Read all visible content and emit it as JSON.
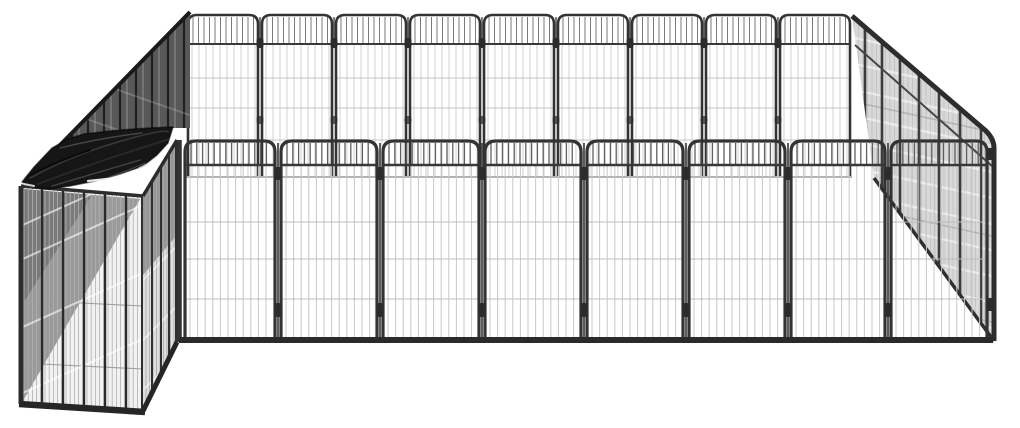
{
  "image": {
    "width": 1020,
    "height": 428,
    "background": "#ffffff",
    "subject": "black powder-coated steel dog playpen with tarp-covered kennel corner, product photo on white, no visible text"
  },
  "palette": {
    "frame": "#333333",
    "frame_dark": "#262626",
    "wire_light": "#c8c8c8",
    "mesh_shade": "#d8d8d8",
    "wedge_shade": "#555555",
    "tarp": "#161616"
  },
  "back_wall": {
    "x0": 186,
    "x1": 852,
    "panels": 9,
    "top": 15,
    "arch_r": 9,
    "crossbar": 44,
    "bottom": 176,
    "frame": "#333333",
    "frame_w": 2.6,
    "band_bar_gap": 5.5,
    "band_bar_color": "#7a7a7a",
    "wire_gap": 7,
    "wire_color": "#cccccc",
    "hwires": [
      78,
      108,
      140
    ],
    "hwire_color": "#c4c4c4",
    "bottom_line_color": "#999999",
    "knob_color": "#2c2c2c",
    "knob_y1": 38,
    "knob_y2": 116
  },
  "right_wall": {
    "poly": [
      [
        852,
        16
      ],
      [
        994,
        139
      ],
      [
        994,
        341
      ],
      [
        874,
        178
      ]
    ],
    "fill": "#d8d8d8",
    "wire_gap": 4.5,
    "wire_color": "#bfbfbf",
    "posts": [
      865,
      882,
      900,
      919,
      939,
      960,
      981
    ],
    "post_color": "#3c3c3c",
    "post_w": 2.6,
    "top_rail_d": "M852,16 L986,131 Q994,139 994,148 L994,341",
    "inner_rail": [
      [
        855,
        45
      ],
      [
        992,
        166
      ]
    ],
    "bottom_rail": [
      [
        874,
        178
      ],
      [
        994,
        341
      ]
    ],
    "rail_color": "#2d2d2d",
    "streaks": [
      {
        "slope": 0.22,
        "x0": 846,
        "x1": 1002,
        "ys": [
          36,
          62,
          88,
          114,
          140,
          166,
          192,
          218,
          244,
          270,
          296,
          322
        ],
        "color": "#ffffff",
        "opacity": 0.5,
        "width": 2.4
      },
      {
        "slope": 0.22,
        "x0": 846,
        "x1": 1002,
        "ys": [
          100,
          204,
          290
        ],
        "color": "#8f8f8f",
        "opacity": 0.45,
        "width": 1.6
      }
    ]
  },
  "left_wedge": {
    "poly": [
      [
        190,
        12
      ],
      [
        26,
        180
      ],
      [
        79,
        136
      ],
      [
        172,
        128
      ],
      [
        190,
        128
      ]
    ],
    "fill": "#585858",
    "shade_poly": [
      [
        26,
        180
      ],
      [
        79,
        136
      ],
      [
        118,
        133
      ],
      [
        70,
        178
      ]
    ],
    "shade_color": "#262626",
    "shade_opacity": 0.7,
    "posts_x": [
      40,
      56,
      72,
      88,
      104,
      120,
      136,
      152,
      168,
      184
    ],
    "post_color": "#1f1f1f",
    "post_w": 2.2,
    "wire_color": "#8f8f8f",
    "top_edge": [
      [
        190,
        12
      ],
      [
        26,
        180
      ]
    ],
    "edge_color": "#1a1a1a",
    "edge_w": 4,
    "streaks": [
      {
        "slope": 0.35,
        "x0": 18,
        "x1": 196,
        "ys": [
          55,
          95,
          135
        ],
        "color": "#ffffff",
        "opacity": 0.18,
        "width": 2
      }
    ]
  },
  "kennel_front": {
    "quad": [
      [
        21,
        186
      ],
      [
        143,
        196
      ],
      [
        143,
        411
      ],
      [
        21,
        404
      ]
    ],
    "fill": "#f2f2f2",
    "dark_tri": [
      [
        24,
        189
      ],
      [
        140,
        199
      ],
      [
        24,
        399
      ]
    ],
    "dark_fill": "#9a9a9a",
    "darker_tri": [
      [
        24,
        189
      ],
      [
        92,
        195
      ],
      [
        24,
        302
      ]
    ],
    "darker_fill": "#6f6f6f",
    "darker_opacity": 0.75,
    "wire_gap": 4.2,
    "wire_color": "#b0b0b0",
    "hwires": [
      300,
      363
    ],
    "hwire_color": "#9f9f9f",
    "posts_x": [
      42,
      63,
      84,
      105,
      126
    ],
    "post_color": "#2a2a2a",
    "post_w": 2.4,
    "streaks": [
      {
        "slope": -0.45,
        "x0": 16,
        "x1": 150,
        "ys": [
          228,
          262,
          330,
          396
        ],
        "color": "#ffffff",
        "opacity": 0.6,
        "width": 2
      }
    ],
    "frame": {
      "top": {
        "pts": [
          [
            21,
            186
          ],
          [
            143,
            196
          ]
        ],
        "c": "#2f2f2f",
        "w": 3.5
      },
      "left": {
        "pts": [
          [
            21,
            186
          ],
          [
            21,
            404
          ]
        ],
        "c": "#2c2c2c",
        "w": 5
      },
      "bottom": {
        "pts": [
          [
            19,
            404
          ],
          [
            145,
            412
          ]
        ],
        "c": "#262626",
        "w": 6.5
      },
      "right": {
        "pts": [
          [
            143,
            196
          ],
          [
            143,
            411
          ]
        ],
        "c": "#2f2f2f",
        "w": 4
      }
    }
  },
  "kennel_side": {
    "quad": [
      [
        143,
        196
      ],
      [
        177,
        140
      ],
      [
        177,
        342
      ],
      [
        143,
        411
      ]
    ],
    "fill": "#dedede",
    "dark_tri": [
      [
        143,
        196
      ],
      [
        177,
        140
      ],
      [
        177,
        235
      ],
      [
        143,
        275
      ]
    ],
    "dark_fill": "#8a8a8a",
    "dark_opacity": 0.85,
    "wire_gap": 3.5,
    "wire_color": "#a8a8a8",
    "posts_x": [
      152,
      161,
      169
    ],
    "post_color": "#303030",
    "post_w": 2,
    "streaks": [
      {
        "slope": -1.0,
        "x0": 138,
        "x1": 182,
        "ys": [
          285,
          345,
          395
        ],
        "color": "#ffffff",
        "opacity": 0.5,
        "width": 1.8
      }
    ],
    "frame": {
      "top": {
        "pts": [
          [
            143,
            196
          ],
          [
            177,
            140
          ]
        ],
        "c": "#2b2b2b",
        "w": 3.5
      },
      "bottom": {
        "pts": [
          [
            143,
            411
          ],
          [
            177,
            342
          ]
        ],
        "c": "#262626",
        "w": 5
      },
      "right": {
        "pts": [
          [
            177,
            140
          ],
          [
            177,
            342
          ]
        ],
        "c": "#2f2f2f",
        "w": 4
      }
    }
  },
  "tarp": {
    "poly": [
      [
        22,
        182
      ],
      [
        34,
        167
      ],
      [
        52,
        148
      ],
      [
        68,
        139
      ],
      [
        84,
        134
      ],
      [
        120,
        130
      ],
      [
        150,
        128
      ],
      [
        173,
        127
      ],
      [
        168,
        143
      ],
      [
        157,
        155
      ],
      [
        143,
        166
      ],
      [
        120,
        174
      ],
      [
        95,
        181
      ],
      [
        70,
        186
      ],
      [
        48,
        189
      ],
      [
        33,
        187
      ]
    ],
    "fill": "#161616",
    "edge_color": "#000000",
    "edge_opacity": 0.55,
    "wrinkles": [
      {
        "d": "M30,178 Q70,156 118,142 T168,132",
        "c": "#3d3d3d",
        "w": 1.6,
        "o": 0.9
      },
      {
        "d": "M38,184 Q85,166 135,150 T170,140",
        "c": "#2a2a2a",
        "w": 2,
        "o": 0.9
      },
      {
        "d": "M52,186 Q100,172 140,160",
        "c": "#4d4d4d",
        "w": 1.4,
        "o": 0.85
      },
      {
        "d": "M60,148 Q100,138 142,133",
        "c": "#565656",
        "w": 1.3,
        "o": 0.8
      },
      {
        "d": "M28,176 Q60,160 90,150",
        "c": "#0a0a0a",
        "w": 2.2,
        "o": 0.9
      },
      {
        "d": "M100,180 Q125,172 145,163",
        "c": "#505050",
        "w": 1.2,
        "o": 0.8
      }
    ],
    "glints": [
      {
        "d": "M88,181 L107,179",
        "c": "#f2f2f2",
        "w": 2.2,
        "o": 0.95
      },
      {
        "d": "M24,184 L34,186",
        "c": "#e8e8e8",
        "w": 2,
        "o": 0.9
      },
      {
        "d": "M139,168 L147,164",
        "c": "#cfcfcf",
        "w": 1.5,
        "o": 0.85
      }
    ]
  },
  "front_wall": {
    "bounds": [
      182,
      278,
      380,
      482,
      584,
      686,
      788,
      888,
      990
    ],
    "top": 141,
    "arch_r": 11,
    "crossbar": 165,
    "bottom": 340,
    "frame": "#333333",
    "frame_w": 3.2,
    "band_bar_gap": 5.8,
    "band_bar_color": "#5f5f5f",
    "wire_gap": 7.6,
    "wire_color": "#c8c8c8",
    "hwires": [
      222,
      259,
      299
    ],
    "hwire_color": "#bdbdbd",
    "bottom_rail_color": "#2a2a2a",
    "bottom_rail_w": 6,
    "corner_left_x": 180,
    "corner_right_x": 990,
    "knob_color": "#2c2c2c",
    "knob_y1": 167,
    "knob_y2": 303,
    "rod_color": "#4a4a4a"
  }
}
